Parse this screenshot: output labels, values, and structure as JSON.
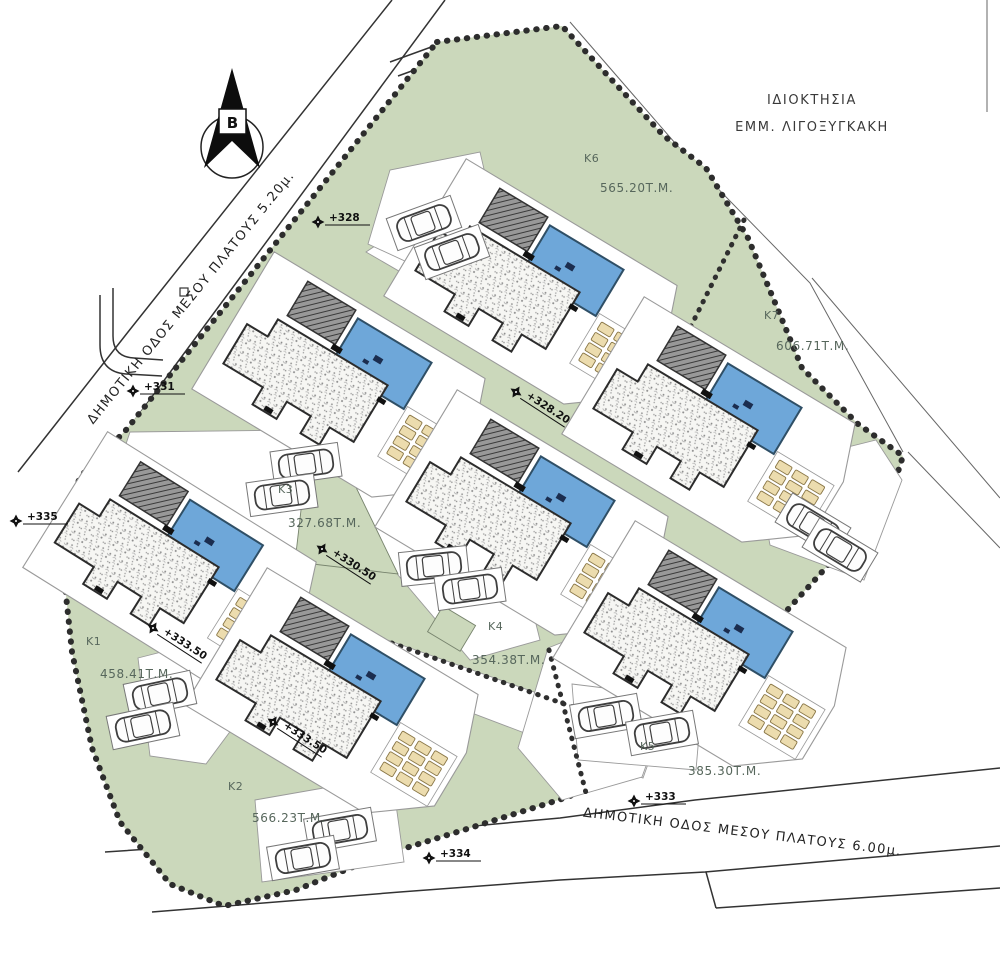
{
  "property": {
    "owner_line1": "ΙΔΙΟΚΤΗΣΙΑ",
    "owner_line2": "ΕΜΜ. ΛΙΓΟΞΥΓΚΑΚΗ"
  },
  "north": {
    "label": "B"
  },
  "roads": {
    "west": {
      "name": "ΔΗΜΟΤΙΚΗ ΟΔΟΣ ΜΕΣΟΥ ΠΛΑΤΟΥΣ 5.20μ."
    },
    "south": {
      "name": "ΔΗΜΟΤΙΚΗ ΟΔΟΣ ΜΕΣΟΥ ΠΛΑΤΟΥΣ 6.00μ."
    }
  },
  "plots": [
    {
      "id": "K1",
      "area": "458.41Τ.Μ."
    },
    {
      "id": "K2",
      "area": "566.23Τ.Μ."
    },
    {
      "id": "K3",
      "area": "327.68Τ.Μ."
    },
    {
      "id": "K4",
      "area": "354.38Τ.Μ."
    },
    {
      "id": "K5",
      "area": "385.30Τ.Μ."
    },
    {
      "id": "K6",
      "area": "565.20Τ.Μ."
    },
    {
      "id": "K7",
      "area": "606.71Τ.Μ."
    }
  ],
  "markers": [
    {
      "label": "+328"
    },
    {
      "label": "+331"
    },
    {
      "label": "+335"
    },
    {
      "label": "+328.20"
    },
    {
      "label": "+330.50"
    },
    {
      "label": "+333.50"
    },
    {
      "label": "+333.50"
    },
    {
      "label": "+333"
    },
    {
      "label": "+334"
    }
  ],
  "colors": {
    "site_green": "#cbd8bb",
    "pool_blue": "#6ea7d9",
    "sunbed_tan": "#ecdcae",
    "boundary": "#2d2d2d",
    "label_green": "#57675c"
  }
}
